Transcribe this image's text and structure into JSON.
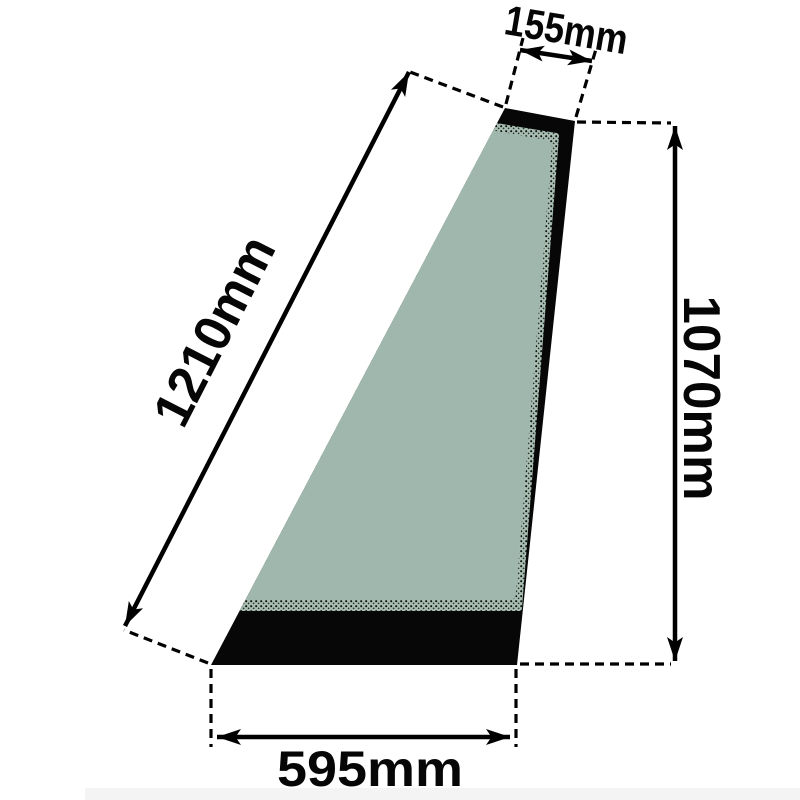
{
  "diagram": {
    "description": "car-quarter-window-glass-dimension-drawing",
    "labels": {
      "top_width": "155mm",
      "slant_length": "1210mm",
      "right_height": "1070mm",
      "bottom_width": "595mm"
    },
    "colors": {
      "glass": "#9fb7ac",
      "frit_speckle_base": "#a9beb3",
      "frame": "#070707",
      "dimension_lines": "#000000",
      "background": "#ffffff"
    }
  }
}
